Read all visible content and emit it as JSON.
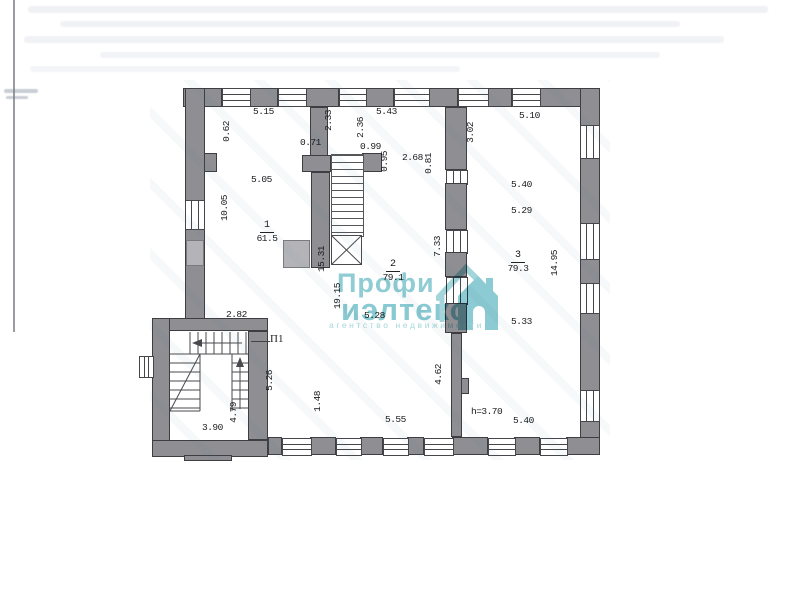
{
  "document": {
    "type": "floor-plan-scan"
  },
  "dimensions": {
    "top_515": "5.15",
    "top_543": "5.43",
    "top_510": "5.10",
    "d_071": "0.71",
    "d_099": "0.99",
    "d_268": "2.68",
    "d_505": "5.05",
    "v_062": "0.62",
    "v_233": "2.33",
    "v_236": "2.36",
    "v_095": "0.95",
    "v_081": "0.81",
    "v_302": "3.02",
    "v_1005": "10.05",
    "v_1531": "15.31",
    "v_1915": "19.15",
    "v_1495": "14.95",
    "v_733": "7.33",
    "d_540a": "5.40",
    "d_529": "5.29",
    "d_533": "5.33",
    "d_282": "2.82",
    "d_528": "5.28",
    "v_462": "4.62",
    "v_148": "1.48",
    "v_526": "5.26",
    "v_479": "4.79",
    "d_390": "3.90",
    "d_555": "5.55",
    "d_h370": "h=3.70",
    "d_540b": "5.40"
  },
  "rooms": [
    {
      "id": "room-1",
      "number": "1",
      "area": "61.5"
    },
    {
      "id": "room-2",
      "number": "2",
      "area": "79.1"
    },
    {
      "id": "room-3",
      "number": "3",
      "area": "79.3"
    }
  ],
  "stair_label": "П1",
  "watermark": {
    "line1": "Профи",
    "line2": "иэлтекс",
    "tagline": "агентство недвижимости",
    "color": "#8fccd4"
  },
  "colors": {
    "wall": "#8e8e93",
    "wall_light": "#b4b4b8",
    "outline": "#3d3d42"
  }
}
